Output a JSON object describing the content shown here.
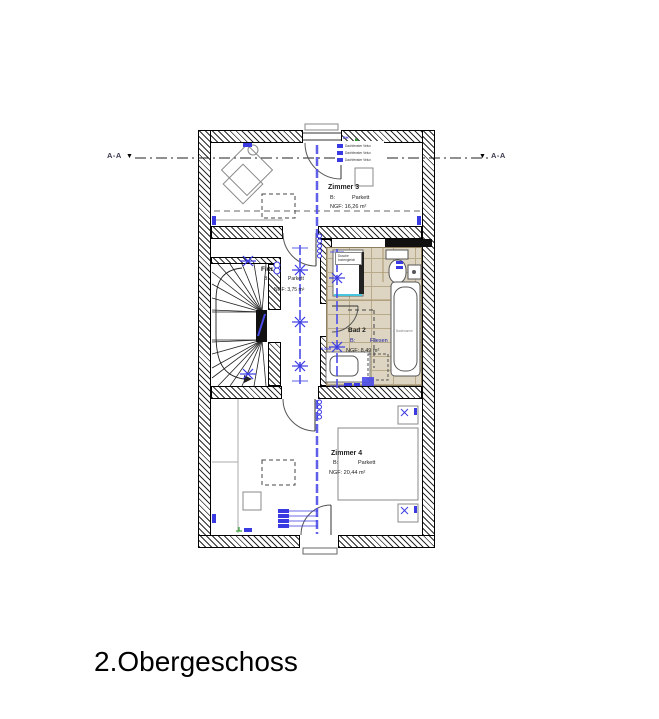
{
  "drawing": {
    "title": "2.Obergeschoss",
    "section_label_left": "A-A",
    "section_label_right": "A-A",
    "section_marker": "▼"
  },
  "rooms": {
    "zimmer3": {
      "name": "Zimmer 3",
      "floor_key": "B:",
      "floor_value": "Parkett",
      "area": "NGF: 16,26 m²"
    },
    "flur": {
      "name": "Flur",
      "floor_key": "B:",
      "floor_value": "Parkett",
      "area": "NGF: 3,75 m²"
    },
    "bad2": {
      "name": "Bad 2",
      "floor_key": "B:",
      "floor_value": "Fliesen",
      "area": "NGF: 8,49 m²"
    },
    "zimmer4": {
      "name": "Zimmer 4",
      "floor_key": "B:",
      "floor_value": "Parkett",
      "area": "NGF: 20,44 m²"
    }
  },
  "annotations": {
    "legend_header": "PH",
    "window_legend": [
      "Dachfenster Velux",
      "Dachfenster Velux",
      "Dachfenster Velux"
    ],
    "shower_note_1": "Dusche",
    "shower_note_2": "bodengleich",
    "bathtub_note": "Badewanne",
    "level_note": "0,000"
  },
  "colors": {
    "electrical_blue": "#3a3ae2",
    "tile_beige": "#ddd5c1",
    "hatch_black": "#2b2b2b",
    "accent_green": "#2f9e2f"
  }
}
